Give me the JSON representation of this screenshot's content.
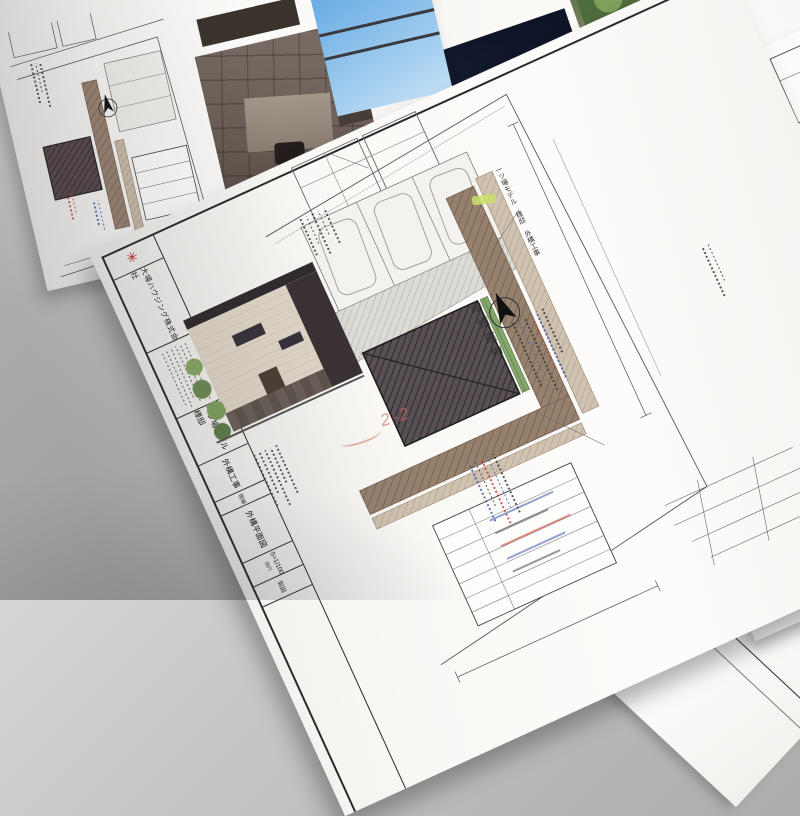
{
  "colors": {
    "logo_red": "#c0272d",
    "paper": "#f7f6f3",
    "table_gray": "#b7b6b4",
    "hatch_brown": "#8d7363",
    "roof_dark": "#4b4247",
    "sky_blue": "#7ab5e6",
    "night_navy": "#131829",
    "note_blue": "#3b55b0",
    "note_red": "#c23a32",
    "handwriting_red": "#cf7a6e",
    "highlighter_yellow": "#cbe06a"
  },
  "main_sheet": {
    "logo_icon": "red-asterisk-logo",
    "company": "大場ハウジング株式会社",
    "plan_caption": "一ツ場モデル 様邸 外構工事",
    "title_block": {
      "project": "一ツ場モデル 様邸",
      "work_type": "外構工事",
      "site_label": "現場",
      "drawing_name": "外構平面図",
      "scale_label": "縮尺",
      "scale_value": "S=1/100",
      "drafter_label": "製図"
    },
    "plan": {
      "building_label": "申請建物",
      "north_icon": "north-arrow"
    },
    "handwritten_mark": "2-2"
  },
  "right_sheet": {
    "logo_icon": "red-asterisk-logo",
    "company": "大場ハウジング株式会社"
  },
  "corner_sheet": {
    "headers": [
      "残土処分",
      "防草シート",
      "砂利敷き",
      "舗装工事",
      "造園工事",
      "中木"
    ]
  }
}
